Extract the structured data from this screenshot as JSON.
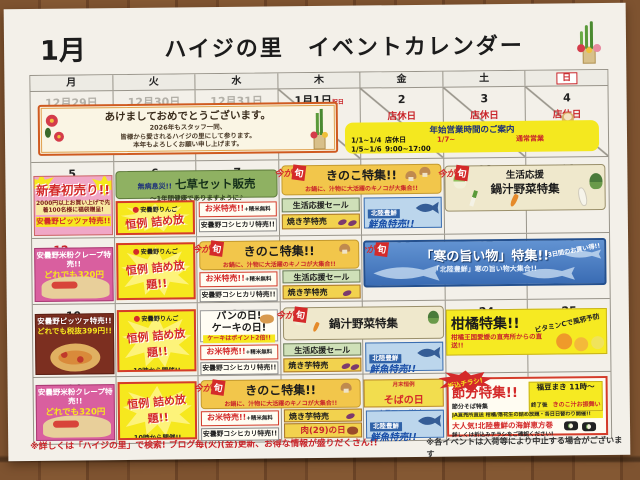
{
  "page": {
    "month": "1月",
    "title": "ハイジの里　イベントカレンダー"
  },
  "weekdays": [
    "月",
    "火",
    "水",
    "木",
    "金",
    "土",
    "日"
  ],
  "week1": {
    "dates": [
      "12月29日",
      "12月30日",
      "12月31日",
      "1月1日",
      "2",
      "3",
      "4"
    ],
    "holiday_note": "祝日",
    "closed_label": "店休日",
    "greeting": {
      "title": "あけましておめでとうございます。",
      "line1": "2026年もスタッフ一同、",
      "line2": "皆様から愛されるハイジの里にして参ります。",
      "line3": "本年もよろしくお願い申し上げます。"
    },
    "hours": {
      "title": "年始営業時間のご案内",
      "closed_range": "1/1~1/4",
      "closed_value": "店休日",
      "short_range": "1/5~1/6",
      "short_value": "9:00~17:00",
      "normal_range": "1/7~",
      "normal_value": "通常営業"
    }
  },
  "week2": {
    "dates": [
      "5",
      "6",
      "7",
      "8",
      "9",
      "10",
      "11"
    ]
  },
  "week3": {
    "dates": [
      "12",
      "13",
      "14",
      "15",
      "16",
      "17",
      "18"
    ],
    "holiday_note": "成人の日"
  },
  "week4": {
    "dates": [
      "19",
      "20",
      "21",
      "22",
      "23",
      "24",
      "25"
    ],
    "season_note": "大寒"
  },
  "week5": {
    "dates": [
      "26",
      "27",
      "28",
      "29",
      "30",
      "31",
      "2月1日"
    ]
  },
  "events": {
    "shun_badge": {
      "ima": "今が",
      "shun": "旬"
    },
    "hatsuuri": {
      "title": "新春初売り!!",
      "detail": "2000円以上お買い上げで先着100名様に福袋贈呈!",
      "pizza": "安曇野ピッツァ特売!!"
    },
    "nanakusa": {
      "lead": "無病息災!!",
      "title": "七草セット販売",
      "sub": "〜1年間健康でありますように♪"
    },
    "ringo": {
      "maker": "安曇野りんご",
      "title": "恒例 詰め放題!!",
      "time": "10時から開催!!",
      "note": "なくなり次第終了"
    },
    "kome": {
      "title": "お米特売!!",
      "plus": "+精米無料",
      "sub": "安曇野コシヒカリ特売!!"
    },
    "kinoko": {
      "title": "きのこ特集!!",
      "sub": "お鍋に、汁物に大活躍のキノコが大集合!!"
    },
    "seikatsu": {
      "label": "生活応援セール"
    },
    "yakiimo": {
      "label": "焼き芋特売"
    },
    "sengyo": {
      "brand": "北陸豊鮮",
      "label": "鮮魚特売!!"
    },
    "nabe_week2": {
      "line1": "生活応援",
      "line2": "鍋汁野菜特集"
    },
    "nabe": {
      "title": "鍋汁野菜特集"
    },
    "kan": {
      "title": "「寒の旨い物」特集!!",
      "sub": "「北陸豊鮮」寒の旨い物大集合!!",
      "note": "3日間のお買い得!!"
    },
    "crepe": {
      "title": "安曇野米粉クレープ特売!!",
      "price": "どれでも320円"
    },
    "pizza": {
      "title": "安曇野ピッツァ特売!!",
      "price": "どれでも税抜399円!!"
    },
    "pan": {
      "title1": "パンの日!",
      "title2": "ケーキの日!",
      "sub": "ケーキはポイント2倍!!"
    },
    "kankitsu": {
      "title": "柑橘特集!!",
      "sub": "柑橘王国愛媛の直売所からの直送!!",
      "note": "ビタミンCで風邪予防"
    },
    "soba": {
      "pre": "月末恒例",
      "title": "そばの日",
      "sub": "安曇野そば特売!!"
    },
    "niku": {
      "label": "肉(29)の日"
    },
    "setsubun": {
      "title": "節分特集!!",
      "sub": "節分そば特集",
      "mame_title": "福豆まき 11時〜",
      "mame_after": "終了後",
      "mame_note": "きのこ汁お振舞い",
      "strip": "JA直売所直送 柑橘/落花生の詰め放題・各日日替わり開催!!",
      "ehomaki": "大人気!北陸豊鮮の海鮮恵方巻",
      "ehomaki_note": "詳しくは折込みチラシをご確認ください!",
      "burst": "折込チラシ!"
    }
  },
  "footer": {
    "left": "※詳しくは「ハイジの里」で検索! ブログ毎(火)(金)更新、お得な情報が盛りだくさん!!",
    "right": "※各イベントは入荷等により中止する場合がございます"
  },
  "colors": {
    "accent_red": "#c9252a",
    "banner_yellow": "#f2c64b",
    "sea_blue": "#3a6cb4",
    "paper": "#f3f0e9"
  }
}
